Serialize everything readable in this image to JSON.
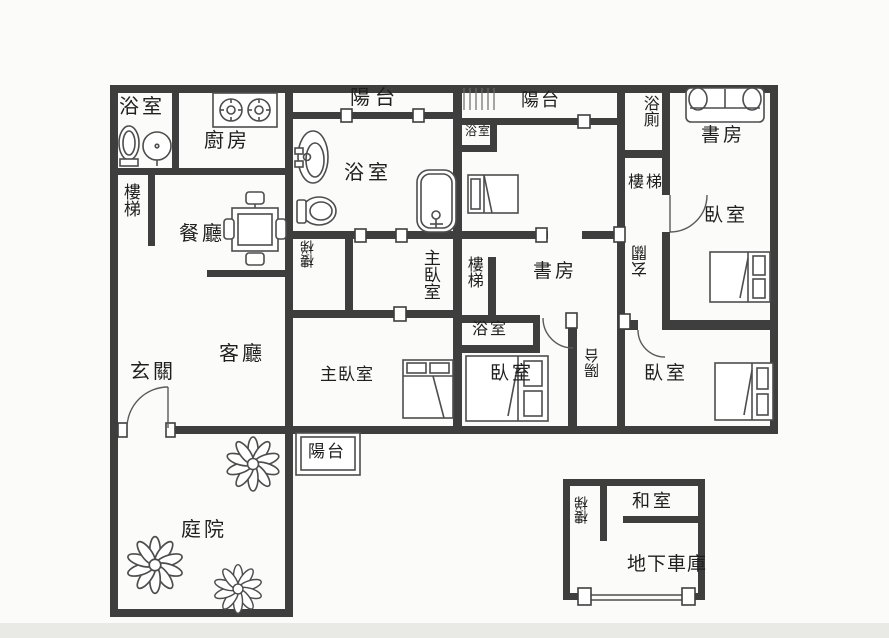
{
  "plan_type": "floor-plan",
  "colors": {
    "wall": "#3e3e3e",
    "fixture_line": "#4d4d4d",
    "text": "#1f1f1f",
    "background": "#fbfbf9",
    "bottom_band": "#e9e9e6"
  },
  "rooms": {
    "bathroom_top_left": "浴室",
    "kitchen": "廚房",
    "stairs_left": "樓梯",
    "dining_room": "餐廳",
    "balcony_top_left": "陽台",
    "bathroom_main": "浴室",
    "bathroom_small": "浴室",
    "balcony_top_right": "陽台",
    "bathroom_wc": "浴廁",
    "study_top_right": "書房",
    "stairs_right": "樓梯",
    "bedroom_top_right": "臥室",
    "entry_right": "玄關",
    "stairs_closet": "樓梯",
    "master_bedroom_vertical": "主臥室",
    "stairs_middle": "樓梯",
    "study_middle": "書房",
    "bathroom_middle_box": "浴室",
    "entry_left": "玄關",
    "living_room": "客廳",
    "master_bedroom": "主臥室",
    "bedroom_middle": "臥室",
    "balcony_strip": "陽台",
    "bedroom_bottom_right": "臥室",
    "balcony_bottom": "陽台",
    "courtyard": "庭院",
    "stairs_garage": "樓梯",
    "tatami_room": "和室",
    "garage": "地下車庫"
  },
  "fixtures": [
    "toilet-icon",
    "sink-icon",
    "bathtub-icon",
    "stove-icon",
    "dining-table-icon",
    "sofa-icon",
    "bed-icon",
    "flower-icon",
    "stairs-treads",
    "door-arc",
    "window-marker"
  ]
}
